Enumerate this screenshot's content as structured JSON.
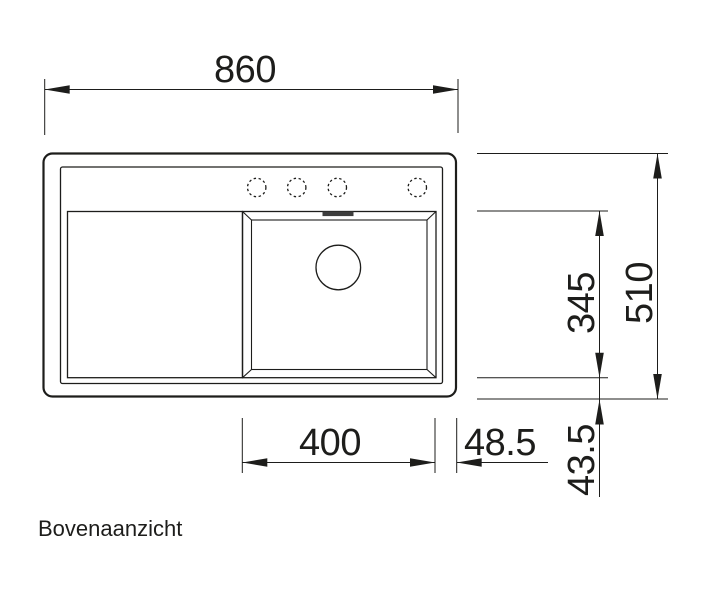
{
  "drawing": {
    "title": "Bovenaanzicht",
    "view": "top-view technical drawing of kitchen sink",
    "dimensions": {
      "total_width": "860",
      "total_depth": "510",
      "basin_depth": "345",
      "basin_width": "400",
      "right_rim": "48.5",
      "front_rim": "43.5"
    },
    "features": {
      "tap_holes": 4,
      "tap_hole_style": "dashed-circle",
      "drain": "circle",
      "overflow": "filled-slot",
      "drainboard": "left",
      "basin": "right-beveled"
    },
    "colors": {
      "ink": "#1d1d1b",
      "background": "#ffffff",
      "overflow_fill": "#3d3d3d"
    }
  }
}
